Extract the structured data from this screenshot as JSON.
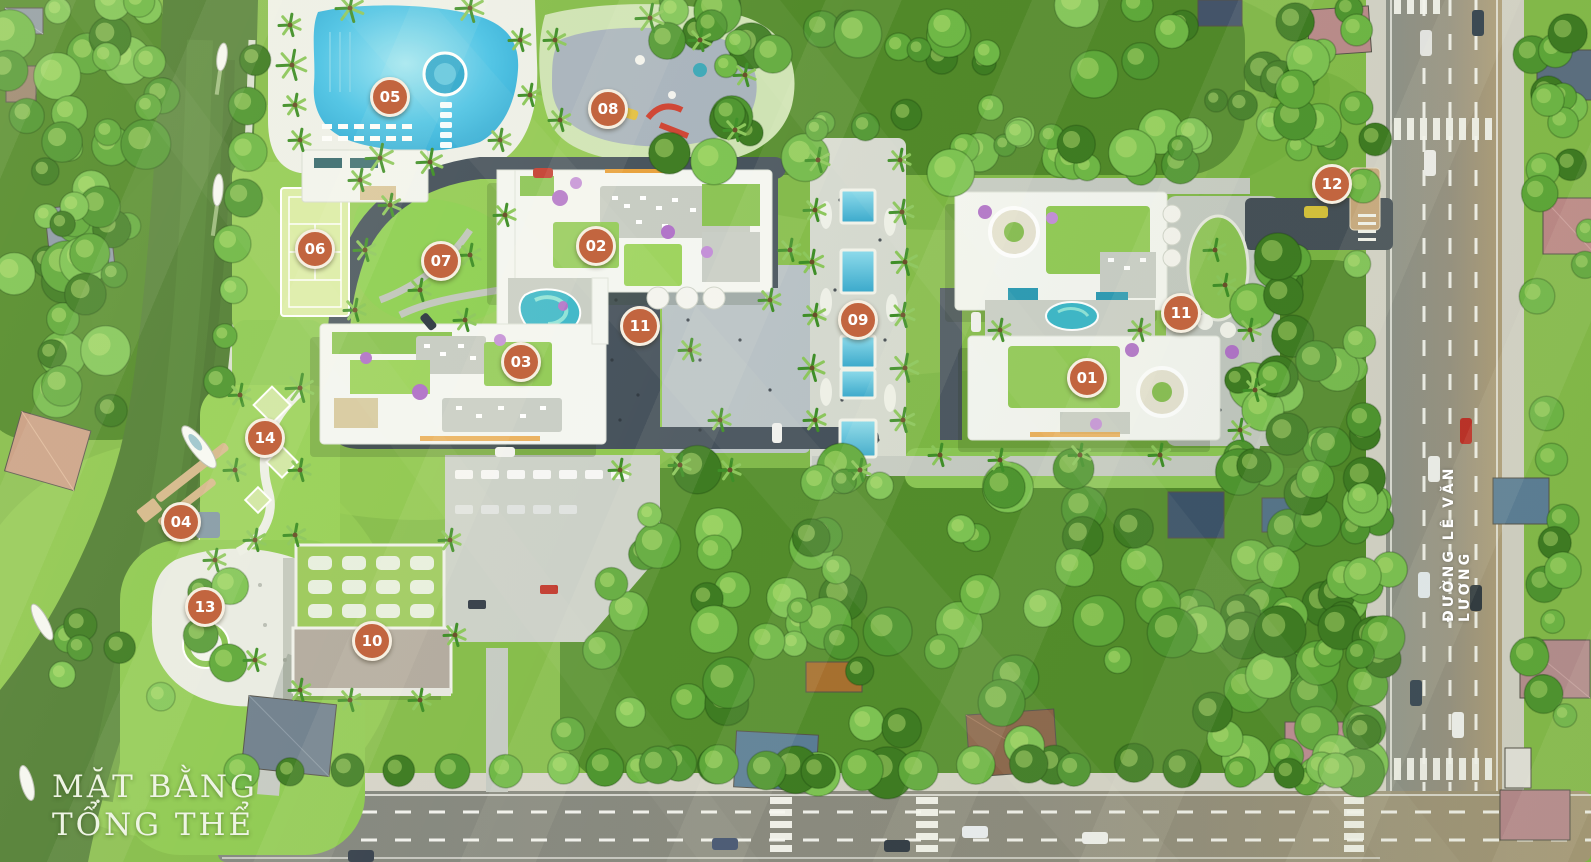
{
  "plan": {
    "title_line1": "MẶT BẰNG",
    "title_line2": "TỔNG THỂ"
  },
  "streets": {
    "main_road_label": "ĐƯỜNG LÊ VĂN LƯƠNG"
  },
  "markers": [
    {
      "number": "01",
      "x": 1087,
      "y": 378
    },
    {
      "number": "02",
      "x": 596,
      "y": 246
    },
    {
      "number": "03",
      "x": 521,
      "y": 362
    },
    {
      "number": "04",
      "x": 181,
      "y": 522
    },
    {
      "number": "05",
      "x": 390,
      "y": 97
    },
    {
      "number": "06",
      "x": 315,
      "y": 249
    },
    {
      "number": "07",
      "x": 441,
      "y": 261
    },
    {
      "number": "08",
      "x": 608,
      "y": 109
    },
    {
      "number": "09",
      "x": 858,
      "y": 320
    },
    {
      "number": "10",
      "x": 372,
      "y": 641
    },
    {
      "number": "11",
      "x": 640,
      "y": 326
    },
    {
      "number": "11",
      "x": 1181,
      "y": 313
    },
    {
      "number": "12",
      "x": 1332,
      "y": 184
    },
    {
      "number": "13",
      "x": 205,
      "y": 607
    },
    {
      "number": "14",
      "x": 265,
      "y": 438
    }
  ],
  "colors": {
    "marker_fill": "#c2653f",
    "marker_ring": "#f6efe1",
    "marker_text": "#ffffff",
    "title_text": "#eef4e4",
    "street_text": "#ffffff"
  }
}
